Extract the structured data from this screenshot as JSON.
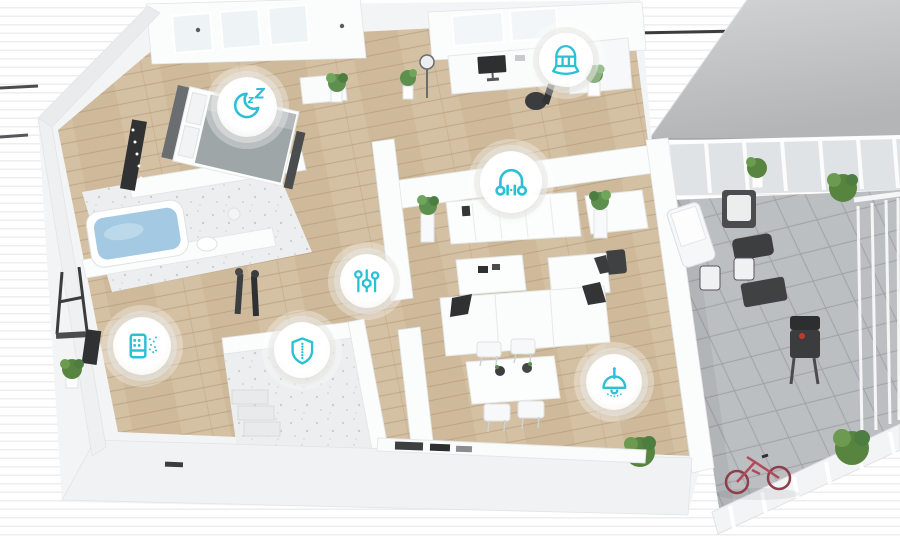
{
  "palette": {
    "accent": "#2cc0d5",
    "wood_floor": "#d3bfa2",
    "terrace_tile": "#b7babc",
    "roof": "#c3c5c7",
    "wall_white": "#f4f5f6",
    "marble": "#edeeef",
    "bath_water": "#a3c9e3",
    "plant_green": "#5d8f4e",
    "bike_red": "#b14a5a",
    "dark_accent": "#3a3c3e"
  },
  "icons": [
    {
      "name": "sleep-mode-icon",
      "shape": "crescent-moon-with-zzz",
      "location": "bedroom"
    },
    {
      "name": "curtain-icon",
      "shape": "arched-curtain-window",
      "location": "office"
    },
    {
      "name": "audio-icon",
      "shape": "headphones-with-equalizer",
      "location": "living-room-console"
    },
    {
      "name": "controls-icon",
      "shape": "vertical-slider-controls",
      "location": "hallway"
    },
    {
      "name": "air-purifier-icon",
      "shape": "purifier-box-with-airflow",
      "location": "entry"
    },
    {
      "name": "security-icon",
      "shape": "shield-with-dotted-line",
      "location": "utility-room"
    },
    {
      "name": "lighting-icon",
      "shape": "pendant-lamp",
      "location": "dining-area"
    }
  ]
}
